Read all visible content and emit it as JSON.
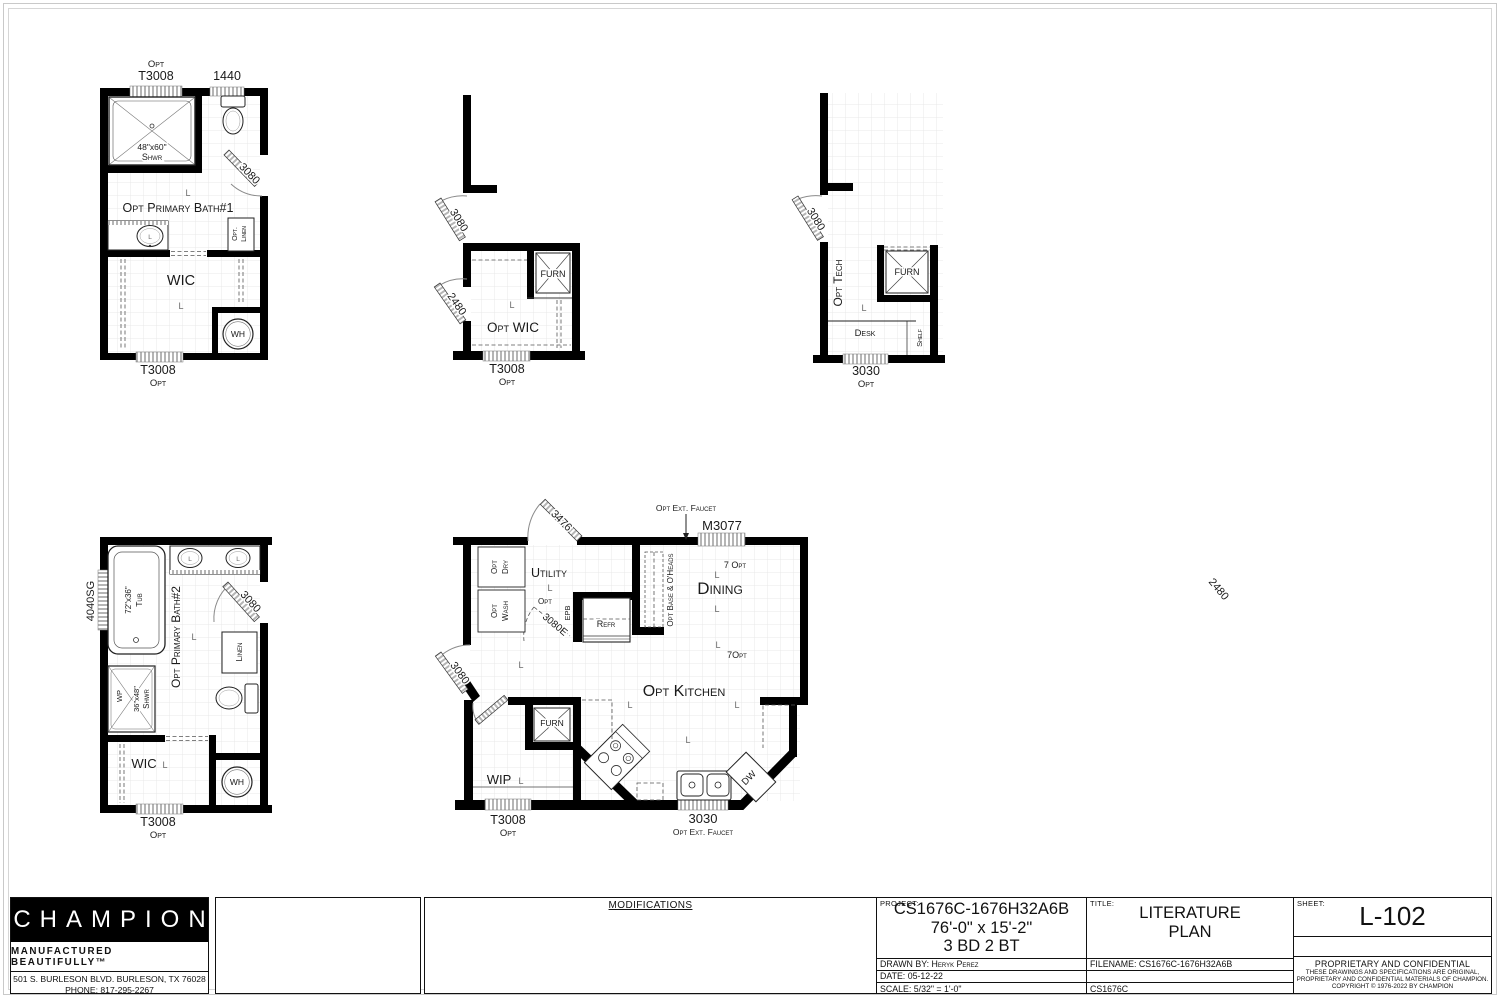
{
  "l": "L",
  "plans": {
    "bath1": {
      "title": "Opt Primary Bath#1",
      "win_top_opt": "Opt",
      "win_top": "T3008",
      "win_toilet": "1440",
      "shwr_size": "48\"x60\"",
      "shwr": "Shwr",
      "door": "3080",
      "linen1": "Opt.",
      "linen2": "Linen",
      "wic": "WIC",
      "wh": "WH",
      "win_bottom": "T3008",
      "win_bottom_opt": "Opt"
    },
    "wic": {
      "title": "Opt WIC",
      "door_top": "3080",
      "door_left": "2480",
      "furn": "FURN",
      "win_bottom": "T3008",
      "win_bottom_opt": "Opt"
    },
    "tech": {
      "title": "Opt Tech",
      "door": "3080",
      "furn": "FURN",
      "desk": "Desk",
      "shelf": "Shelf",
      "win_bottom": "3030",
      "win_bottom_opt": "Opt"
    },
    "bath2": {
      "title": "Opt Primary Bath#2",
      "win_left": "4040SG",
      "tub_size": "72\"x36\"",
      "tub": "Tub",
      "door": "3080",
      "linen": "Linen",
      "wp": "WP",
      "shwr_size": "36\"x48\"",
      "shwr": "Shwr",
      "wic": "WIC",
      "wh": "WH",
      "win_bottom": "T3008",
      "win_bottom_opt": "Opt"
    },
    "kitchen": {
      "title": "Opt Kitchen",
      "faucet_top": "Opt Ext. Faucet",
      "win_top": "M3077",
      "door_top": "3476",
      "door_left": "3080",
      "door_wip": "2480",
      "opt1": "Opt",
      "dry": "Dry",
      "opt2": "Opt",
      "wash": "Wash",
      "utility": "Utility",
      "door_opt": "Opt",
      "door_e": "3080E",
      "epb": "EPB",
      "refr": "Refr",
      "base": "Opt Base & O'Heads",
      "dining": "Dining",
      "opt7a": "7 Opt",
      "opt7b": "7Opt",
      "furn": "FURN",
      "wip": "WIP",
      "dw": "DW",
      "win_bl": "T3008",
      "win_bl_opt": "Opt",
      "win_bottom": "3030",
      "faucet_bottom": "Opt Ext. Faucet"
    }
  },
  "title_block": {
    "brand": "CHAMPION",
    "tagline": "MANUFACTURED BEAUTIFULLY™",
    "address": "501 S. BURLESON BLVD.  BURLESON, TX  76028",
    "phone": "PHONE: 817-295-2267",
    "modifications": "MODIFICATIONS",
    "project_label": "PROJECT:",
    "project_code": "CS1676C-1676H32A6B",
    "project_size": "76'-0\" x 15'-2\"",
    "project_beds": "3 BD 2 BT",
    "drawn_by": "DRAWN BY: Heryk Perez",
    "date": "DATE: 05-12-22",
    "scale": "SCALE: 5/32\" = 1'-0\"",
    "title_label": "TITLE:",
    "title_line1": "LITERATURE",
    "title_line2": "PLAN",
    "filename": "FILENAME: CS1676C-1676H32A6B",
    "model": "CS1676C",
    "sheet_label": "SHEET:",
    "sheet": "L-102",
    "conf_title": "PROPRIETARY AND CONFIDENTIAL",
    "conf_line1": "THESE DRAWINGS AND SPECIFICATIONS ARE ORIGINAL,",
    "conf_line2": "PROPRIETARY AND CONFIDENTIAL MATERIALS OF CHAMPION.",
    "conf_line3": "COPYRIGHT © 1976-2022 BY CHAMPION"
  }
}
